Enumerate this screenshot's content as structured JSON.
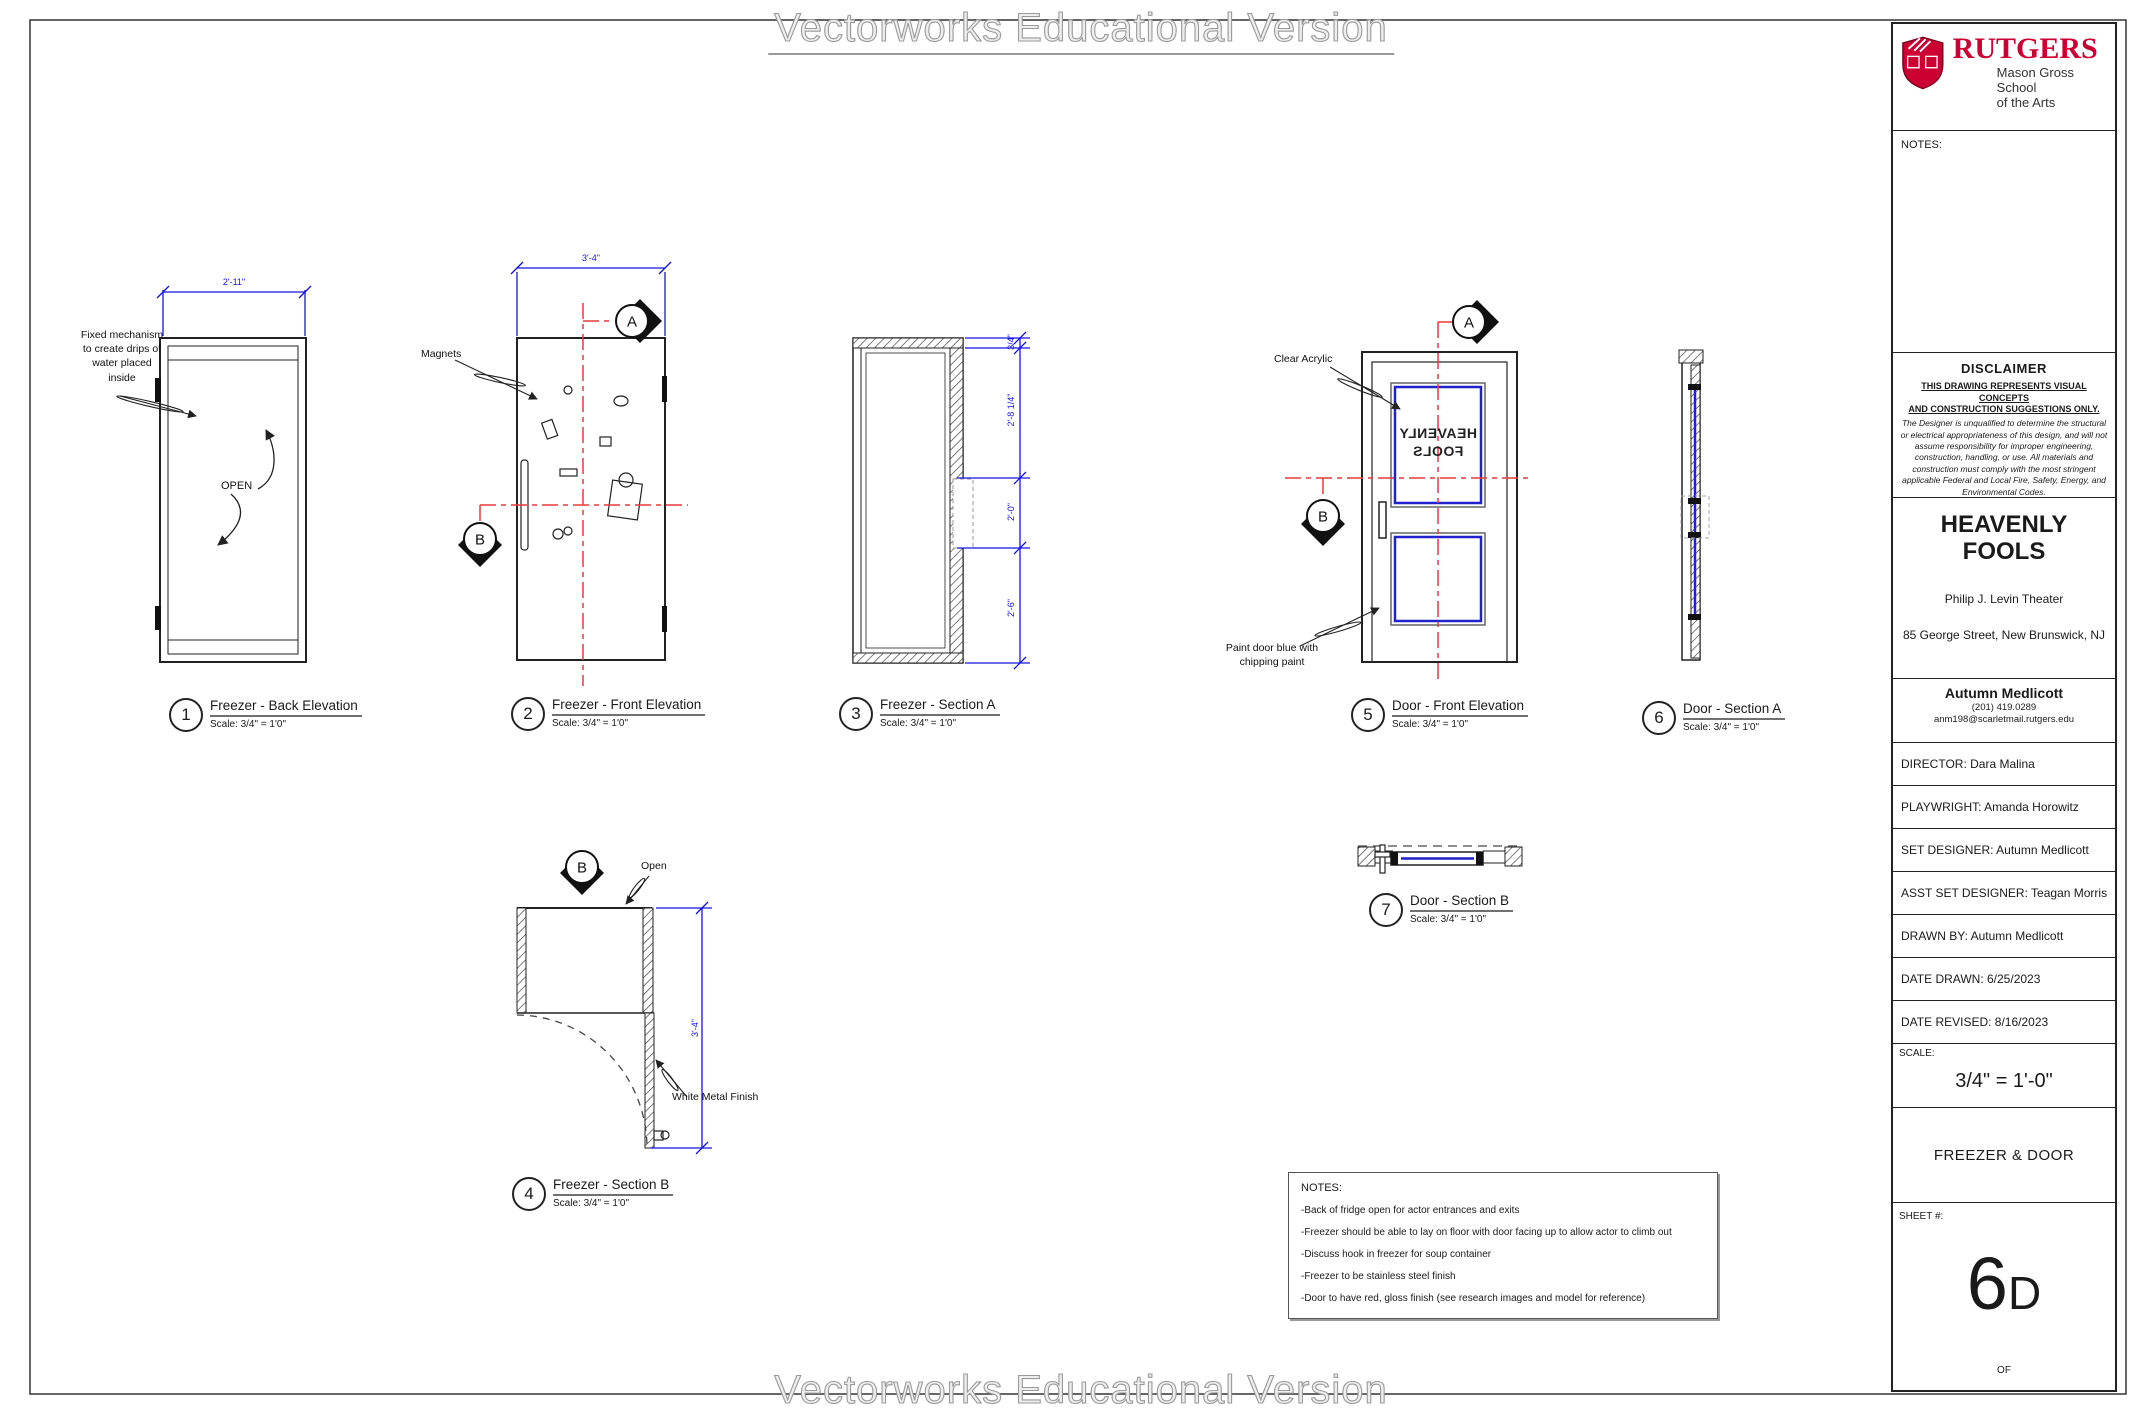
{
  "watermark": {
    "text": "Vectorworks Educational Version"
  },
  "colors": {
    "rutgers_red": "#cc0033",
    "dimension_blue": "#1414e0",
    "section_line_red": "#e83a3a",
    "window_blue": "#2222cc",
    "line_dark": "#222222"
  },
  "markers": {
    "a": "A",
    "b": "B"
  },
  "drawings": {
    "d1": {
      "number": "1",
      "title": "Freezer - Back Elevation",
      "scale": "Scale: 3/4\" = 1'0\"",
      "dim_width": "2'-11\"",
      "annotation": "Fixed mechanism\nto create drips of\nwater placed\ninside",
      "open_label": "OPEN"
    },
    "d2": {
      "number": "2",
      "title": "Freezer - Front Elevation",
      "scale": "Scale: 3/4\" = 1'0\"",
      "dim_width": "3'-4\"",
      "annotation_magnets": "Magnets"
    },
    "d3": {
      "number": "3",
      "title": "Freezer - Section A",
      "scale": "Scale: 3/4\" = 1'0\"",
      "dims": [
        "3/4\"",
        "2'-8 1/4\"",
        "2'-0\"",
        "2'-6\""
      ]
    },
    "d4": {
      "number": "4",
      "title": "Freezer - Section B",
      "scale": "Scale: 3/4\" = 1'0\"",
      "dim_height": "3'-4\"",
      "annotation_open": "Open",
      "annotation_finish": "White Metal Finish"
    },
    "d5": {
      "number": "5",
      "title": "Door - Front Elevation",
      "scale": "Scale: 3/4\" = 1'0\"",
      "annotation_acrylic": "Clear Acrylic",
      "annotation_paint": "Paint door blue with\nchipping paint",
      "mirrored_text": "HEAVENLY\nFOOLS"
    },
    "d6": {
      "number": "6",
      "title": "Door - Section A",
      "scale": "Scale: 3/4\" = 1'0\""
    },
    "d7": {
      "number": "7",
      "title": "Door - Section B",
      "scale": "Scale: 3/4\" = 1'0\""
    }
  },
  "notes_box": {
    "title": "NOTES:",
    "items": [
      "-Back of fridge open for actor entrances and exits",
      "-Freezer should be able to lay on floor with door facing up to allow actor to climb out",
      "-Discuss hook in freezer for soup container",
      "-Freezer to be stainless steel finish",
      "-Door to have red, gloss finish (see research images and model for reference)"
    ]
  },
  "title_block": {
    "logo": {
      "wordmark": "RUTGERS",
      "school_line1": "Mason Gross School",
      "school_line2": "of the Arts"
    },
    "notes_label": "NOTES:",
    "disclaimer": {
      "heading": "DISCLAIMER",
      "underlined": "THIS DRAWING REPRESENTS VISUAL CONCEPTS\nAND CONSTRUCTION SUGGESTIONS ONLY.",
      "body": "The Designer is unqualified to determine the structural or electrical appropriateness of this design, and will not assume responsibility for improper engineering, construction, handling, or use.  All materials and construction must comply with the most stringent applicable Federal and Local Fire, Safety, Energy, and Environmental Codes."
    },
    "show": {
      "title_line1": "HEAVENLY",
      "title_line2": "FOOLS",
      "venue": "Philip J. Levin Theater",
      "address": "85 George Street, New Brunswick, NJ"
    },
    "designer": {
      "name": "Autumn Medlicott",
      "phone": "(201) 419.0289",
      "email": "anm198@scarletmail.rutgers.edu"
    },
    "rows": [
      "DIRECTOR: Dara Malina",
      "PLAYWRIGHT: Amanda Horowitz",
      "SET DESIGNER: Autumn Medlicott",
      "ASST SET DESIGNER: Teagan Morris",
      "DRAWN BY: Autumn Medlicott",
      "DATE DRAWN: 6/25/2023",
      "DATE REVISED: 8/16/2023"
    ],
    "scale": {
      "label": "SCALE:",
      "value": "3/4\" = 1'-0\""
    },
    "sheet_title": "FREEZER & DOOR",
    "sheet": {
      "label": "SHEET #:",
      "number": "6",
      "suffix": "D",
      "of_label": "OF"
    }
  }
}
